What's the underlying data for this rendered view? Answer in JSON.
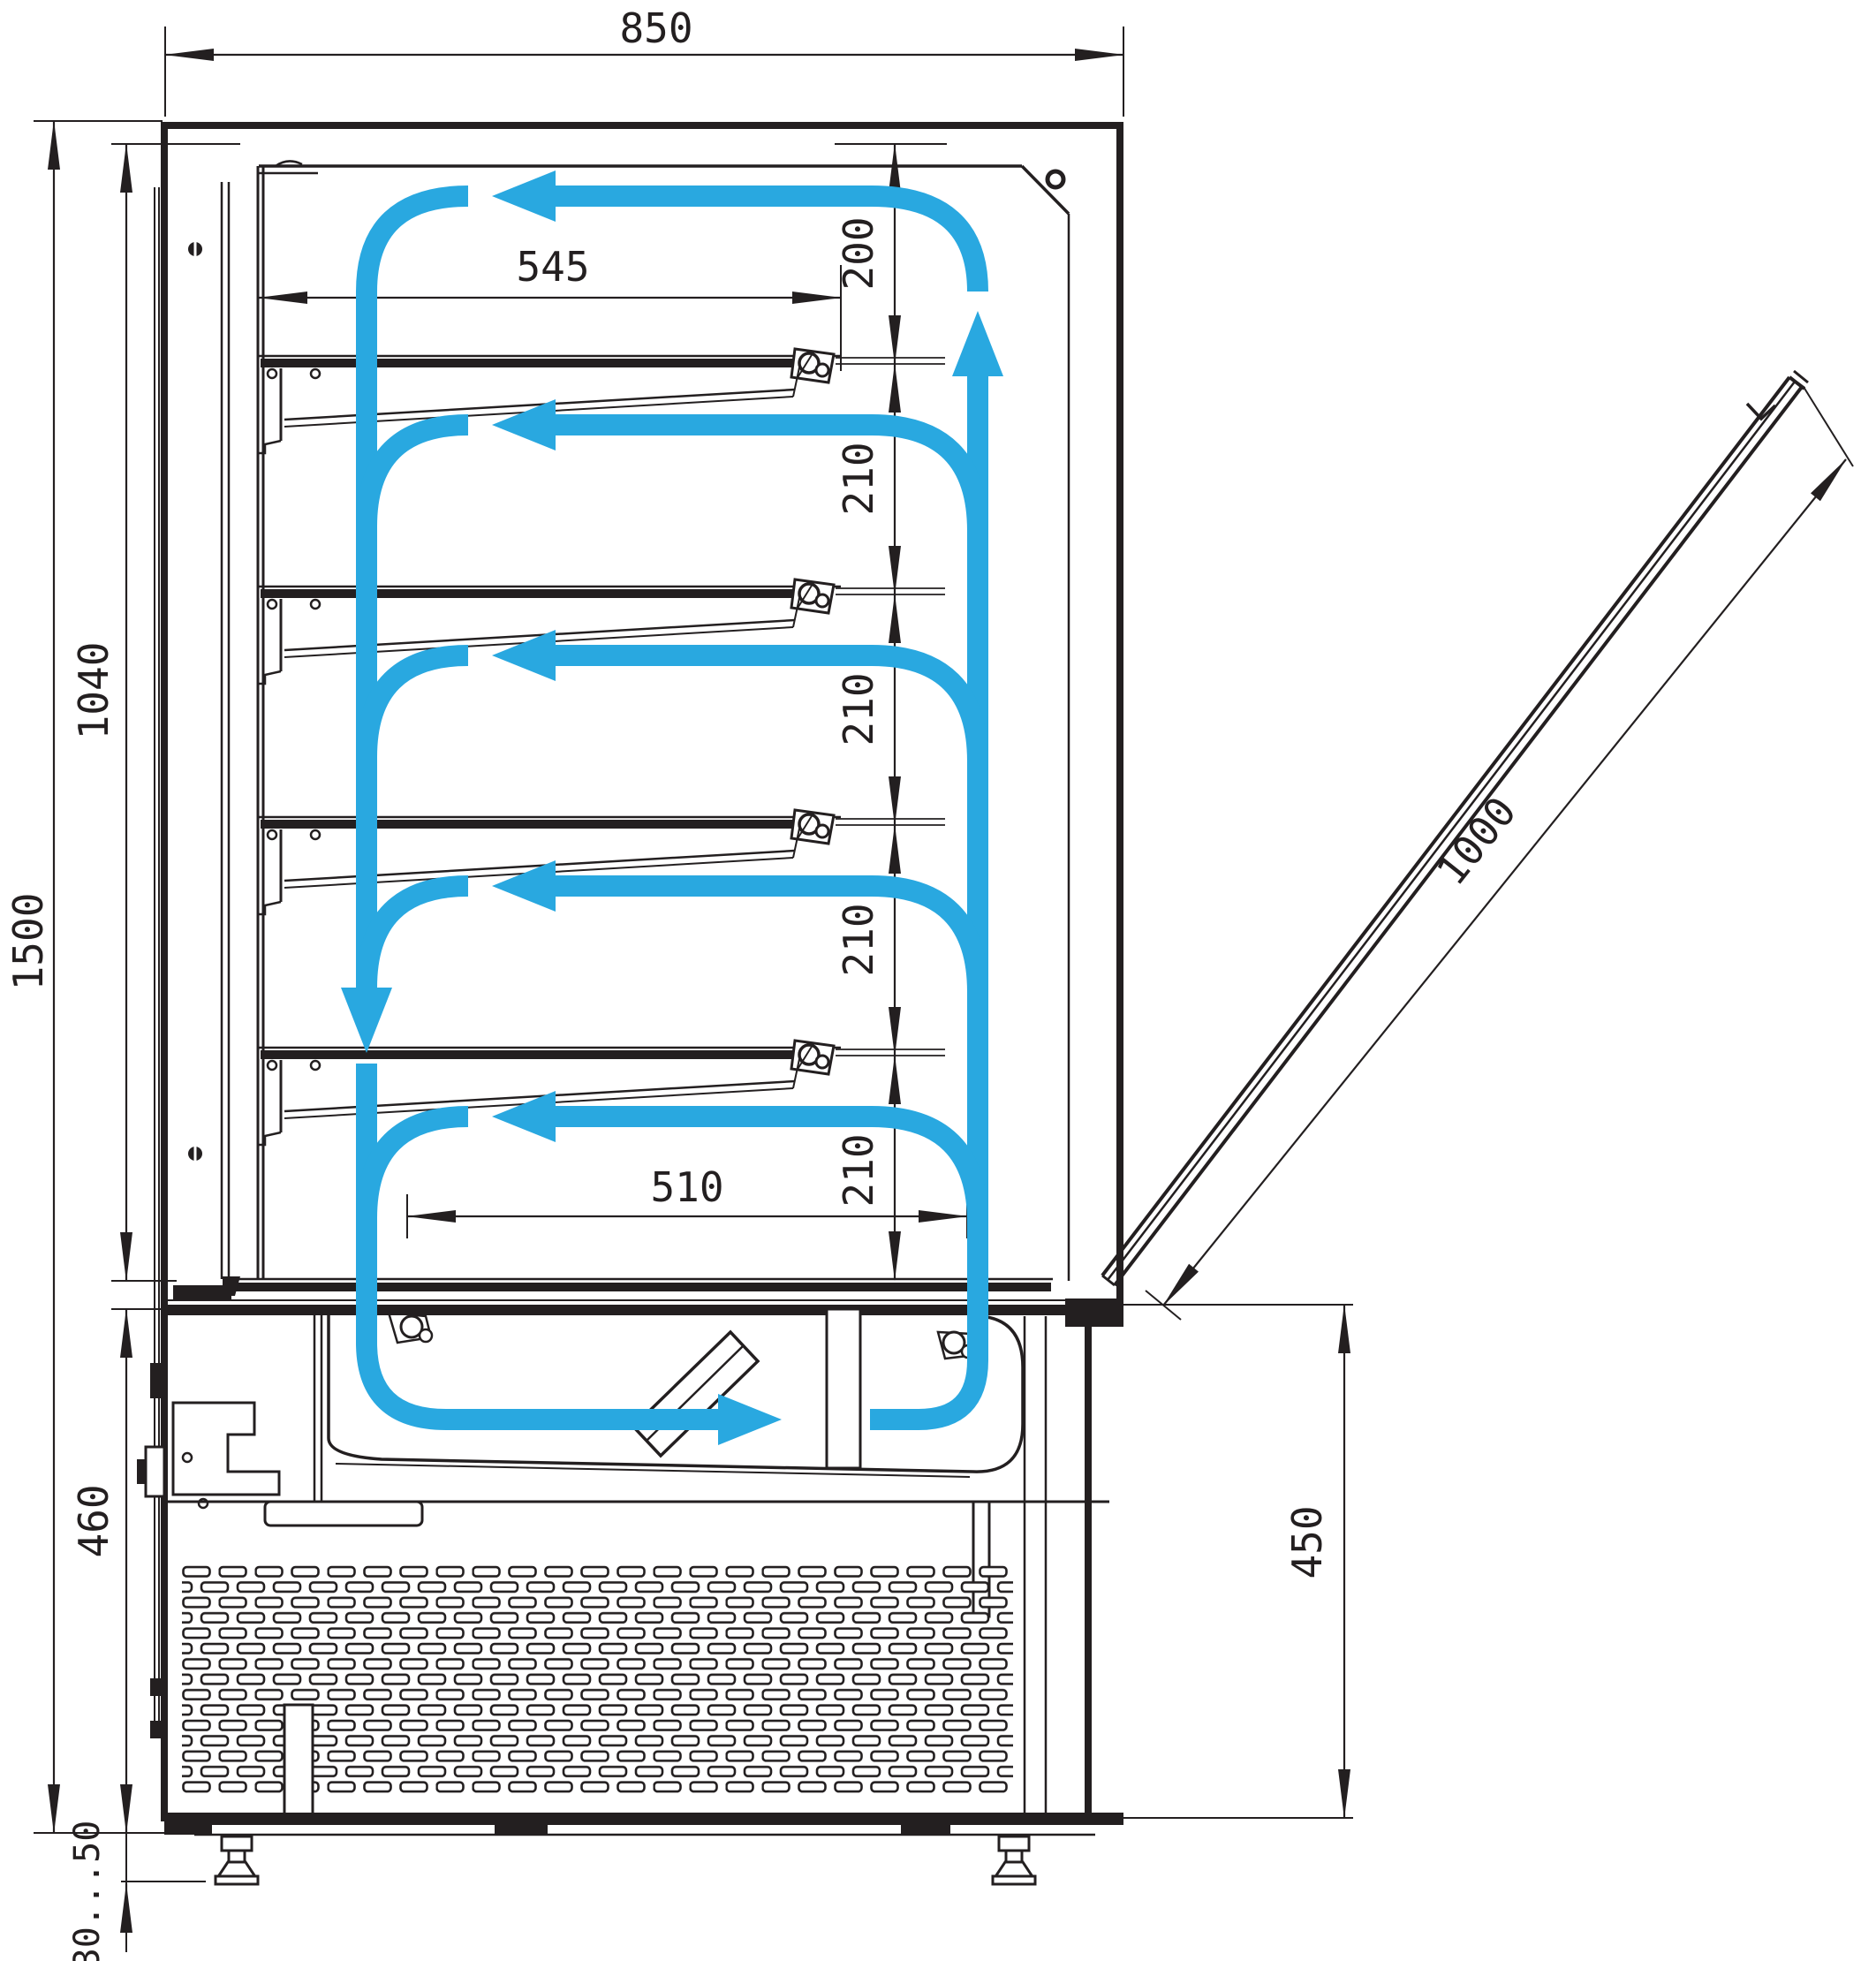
{
  "diagram": {
    "type": "technical-drawing",
    "subject": "refrigerated-display-case-side-section-with-airflow",
    "background_color": "#ffffff",
    "line_color": "#231f20",
    "airflow_color": "#29a8e0",
    "dimension_labels": {
      "overall_width_mm": "850",
      "overall_height_mm": "1500",
      "display_opening_height_mm": "1040",
      "base_height_mm": "460",
      "leg_height_range_mm": "30...50",
      "top_shelf_depth_mm": "545",
      "bottom_shelf_depth_mm": "510",
      "top_air_gap_mm": "200",
      "shelf_gaps_mm": [
        "210",
        "210",
        "210",
        "210"
      ],
      "base_front_height_mm": "450",
      "front_glass_length_mm": "1000"
    }
  }
}
